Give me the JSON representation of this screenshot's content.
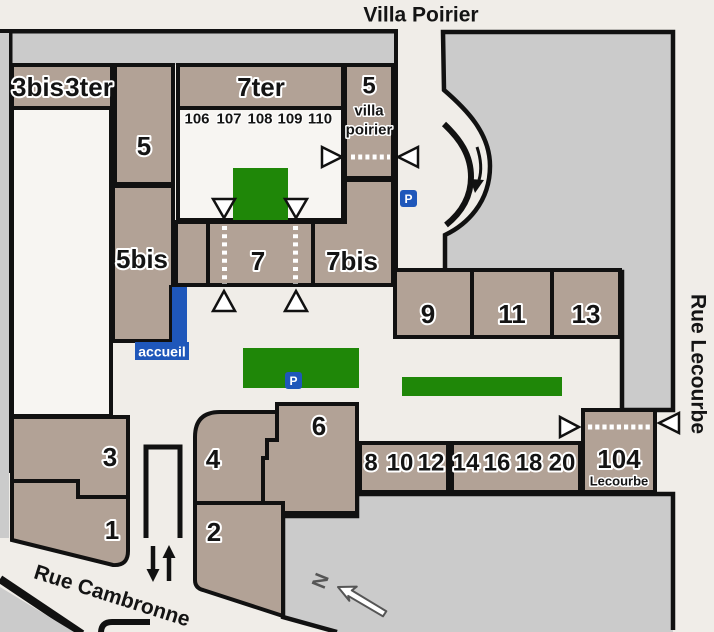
{
  "colors": {
    "background": "#f0ede8",
    "building_fill": "#b2a296",
    "outline": "#111111",
    "street_gray": "#cbcbcb",
    "courtyard_white": "#f7f5f2",
    "green_space": "#1f8708",
    "accent_blue": "#1f57ba",
    "north_gray": "#555555"
  },
  "streets": {
    "top": "Villa Poirier",
    "right": "Rue Lecourbe",
    "bottom": "Rue Cambronne"
  },
  "buildings": {
    "b3bis": "3bis",
    "b3ter": "3ter",
    "b5": "5",
    "b7ter": "7ter",
    "b5vp": {
      "num": "5",
      "line1": "villa",
      "line2": "poirier"
    },
    "b5bis": "5bis",
    "b7": "7",
    "b7bis": "7bis",
    "b9": "9",
    "b11": "11",
    "b13": "13",
    "b3": "3",
    "b1": "1",
    "b4": "4",
    "b2": "2",
    "b6": "6",
    "row_a": [
      "8",
      "10",
      "12"
    ],
    "row_b": [
      "14",
      "16",
      "18",
      "20"
    ],
    "b104": {
      "num": "104",
      "name": "Lecourbe"
    },
    "court_units": [
      "106",
      "107",
      "108",
      "109",
      "110"
    ]
  },
  "markers": {
    "reception": "accueil",
    "parking": "P",
    "north": "N"
  }
}
